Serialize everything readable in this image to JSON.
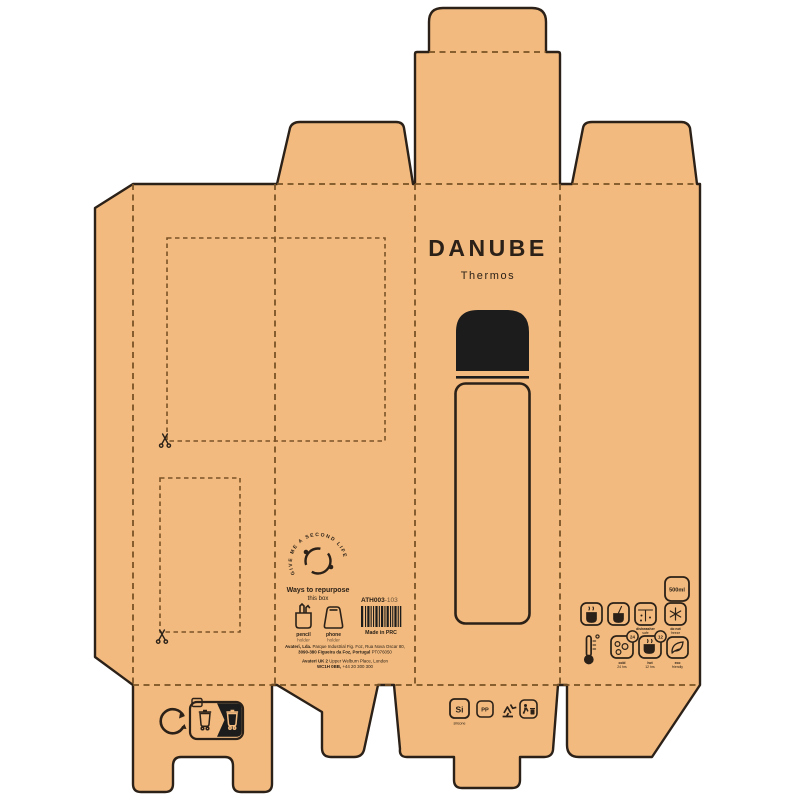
{
  "colors": {
    "kraft": "#f2ba7e",
    "ink": "#2b2118",
    "fold_line": "#7a5326",
    "black_fill": "#1c1c1c",
    "background": "#ffffff"
  },
  "front_panel": {
    "brand": "DANUBE",
    "subtitle": "Thermos"
  },
  "info_panel": {
    "second_life_circle_text": "GIVE ME A SECOND LIFE",
    "repurpose_heading": "Ways to repurpose",
    "repurpose_subheading": "this box",
    "repurpose_options": [
      {
        "name": "pencil",
        "type": "holder"
      },
      {
        "name": "phone",
        "type": "holder"
      }
    ],
    "sku": "ATH003",
    "sku_variant": "-103",
    "made_in": "Made in PRC",
    "address_line1_bold": "Avateri, Lda.",
    "address_line1_rest": " Parque Industrial Fig. Foz, Rua Nova Oscar 80,",
    "address_line2_bold": "3090-380 Figueira da Foz, Portugal",
    "address_line2_rest": " PT076050",
    "address_line3_bold": "Avateri UK 2",
    "address_line3_rest": " Upper Welburn Place, London",
    "address_line4_bold": "WC1H 0BB,",
    "address_line4_rest": " +44 20 300 300"
  },
  "features_panel": {
    "capacity": "500ml",
    "row1": [
      {
        "icon": "hot-drink-icon",
        "label1": "",
        "label2": ""
      },
      {
        "icon": "cold-drink-icon",
        "label1": "",
        "label2": ""
      },
      {
        "icon": "dishwasher-safe-icon",
        "label1": "dishwasher",
        "label2": "safe"
      },
      {
        "icon": "do-not-freeze-icon",
        "label1": "do not",
        "label2": "freeze"
      }
    ],
    "row2": [
      {
        "icon": "thermometer-icon",
        "label1": "",
        "label2": ""
      },
      {
        "icon": "cold-24h-icon",
        "badge": "24",
        "label1": "cold",
        "label2": "24 hrs"
      },
      {
        "icon": "hot-12h-icon",
        "badge": "12",
        "label1": "hot",
        "label2": "12 hrs"
      },
      {
        "icon": "eco-leaf-icon",
        "label1": "eco",
        "label2": "friendly"
      }
    ]
  },
  "bottom_flap": {
    "material_si": "Si",
    "material_si_label": "silicone",
    "material_pp": "PP"
  }
}
